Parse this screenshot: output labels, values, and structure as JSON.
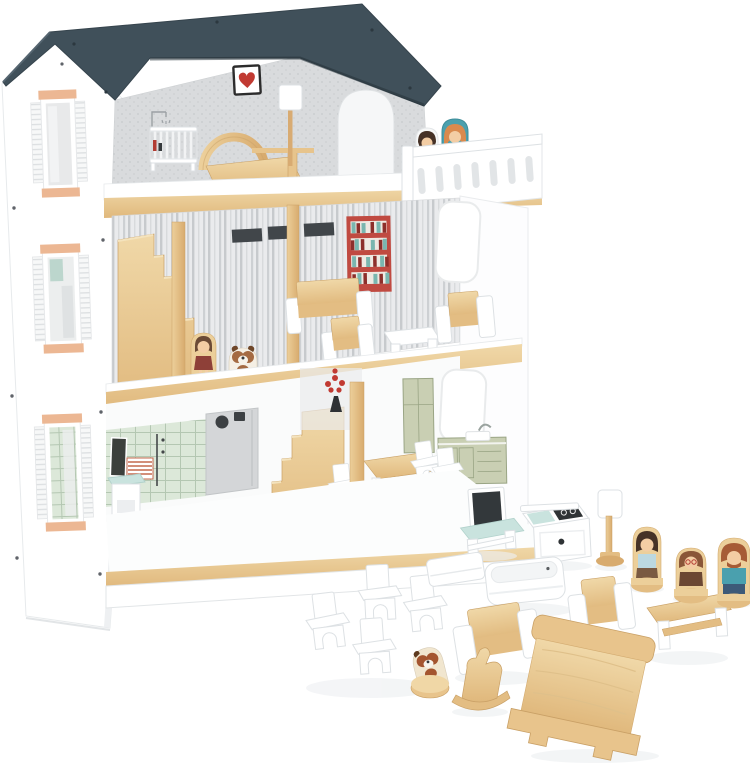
{
  "scene": {
    "kind": "product-photo",
    "background": "#ffffff",
    "subject": "Three-story wooden dollhouse playset with furniture, peg dolls and pets"
  },
  "palette": {
    "bg": "#ffffff",
    "roof": "#40505a",
    "roofEdge": "#2e3c44",
    "wood": "#eed5a2",
    "woodMid": "#e3bd83",
    "woodDark": "#c9a066",
    "wallDotsBg": "#d9dbdd",
    "wallDot": "#c7cacc",
    "stripeBg": "#eaebed",
    "stripe": "#c7cacd",
    "tileBg": "#dce8d9",
    "tileLine": "#b4c7b2",
    "sage": "#c9cfb3",
    "sageLine": "#9aa585",
    "grayPanel": "#d4d6d8",
    "dark": "#36393c",
    "heartRed": "#c13a32",
    "decalRed": "#c04a41",
    "bookTeal": "#7ab6af",
    "mint": "#c9e3de",
    "peach": "#ecb793",
    "skin": "#f3cda4",
    "hairBrown": "#6b4a35",
    "hairDark": "#463227",
    "hairOrange": "#d98a4e",
    "tealCloth": "#4aa0ae",
    "maroon": "#8e4038",
    "navy": "#3d5a78",
    "babyBlue": "#bcd8e0",
    "brownCloth": "#7a5a42",
    "shadow": "#eef0f2"
  },
  "house": {
    "label": "three-story wooden dollhouse with open front",
    "roof": {
      "label": "slate gray gabled roof panel"
    },
    "left_wall": {
      "label": "white exterior side wall with three shuttered windows with peach trim"
    },
    "attic": {
      "label": "attic bedroom",
      "decor": [
        "framed heart picture",
        "shower line-art decal",
        "white baby crib",
        "wooden bed with arched headboard",
        "floor lamp",
        "arched doorway",
        "dotted gray wallpaper"
      ],
      "balcony": {
        "label": "white balustrade balcony",
        "figures": [
          "girl peg doll with dark hair and white dress",
          "woman peg doll with orange hair and teal top"
        ]
      }
    },
    "middle": {
      "label": "living room floor",
      "decor": [
        "three dark transom windows",
        "red bookshelf wall decal",
        "striped wallpaper",
        "round-corner window",
        "flower wall dots"
      ],
      "furniture": [
        "wooden sofa with white arms",
        "two armchairs",
        "white coffee table"
      ],
      "figures": [
        "girl peg doll in maroon dress",
        "puppy figure"
      ],
      "stairs": "wooden staircase to attic"
    },
    "ground": {
      "label": "kitchen and bathroom floor",
      "decor": [
        "mint tiled wall",
        "chalkboard",
        "radiator decal",
        "gray laundry door with porthole",
        "flower vase decal",
        "sage green kitchen cabinets with sink",
        "round-corner window"
      ],
      "furniture": [
        "white wash stand with mint top",
        "wooden dining table",
        "small white chairs"
      ],
      "stairs": "wooden staircase to middle floor"
    }
  },
  "loose_items": {
    "tv_stand": {
      "label": "TV with dark screen on white media stand with mint top"
    },
    "stove": {
      "label": "white stove unit with dark cooktop decal"
    },
    "floor_lamp": {
      "label": "floor lamp with white shade and wooden pole"
    },
    "chairs": {
      "label": "four white dining chairs"
    },
    "mattress": {
      "label": "white mattress"
    },
    "bathtub": {
      "label": "white bathtub"
    },
    "sofa": {
      "label": "wooden sofa with white armrests"
    },
    "dog_figure": {
      "label": "tilted puppy peg figure"
    },
    "rocking_horse": {
      "label": "wooden rocking horse"
    },
    "armchair": {
      "label": "wooden armchair with white sides"
    },
    "coffee_table": {
      "label": "wooden coffee table with white legs"
    },
    "bed": {
      "label": "large natural wood bed"
    }
  },
  "figures": {
    "mother": {
      "label": "mother peg doll, dark hair, light blue top, brown skirt"
    },
    "grandmother": {
      "label": "grandmother peg doll, auburn hair, brown dress"
    },
    "father": {
      "label": "father peg doll, beard, teal shirt, navy trousers"
    }
  }
}
